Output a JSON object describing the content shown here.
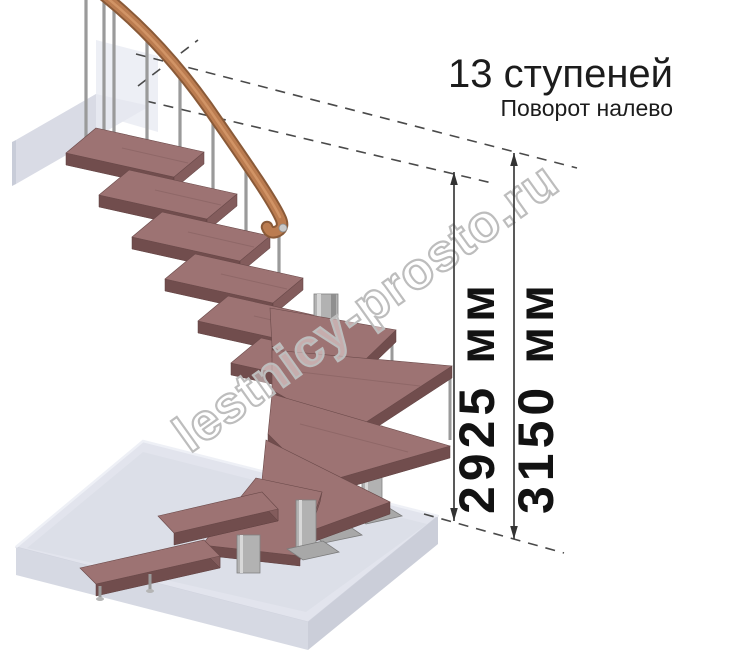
{
  "annotations": {
    "title": "13 ступеней",
    "subtitle": "Поворот налево"
  },
  "dimensions": [
    {
      "label": "2925 мм"
    },
    {
      "label": "3150 мм"
    }
  ],
  "watermark": {
    "text": "lestnicy-prosto.ru"
  },
  "figure": {
    "steps_shown": "13",
    "turn": "налево"
  },
  "colors": {
    "tread_wood": "#9d7373",
    "tread_edge": "#714d4d",
    "rail_wood": "#bb7c50",
    "metal": "#b2b2b2",
    "floor_slab": "#e2e4ed",
    "dashed_line": "#4a4a4a",
    "text": "#1c1c1c",
    "watermark_outline": "#bdbdbd"
  }
}
